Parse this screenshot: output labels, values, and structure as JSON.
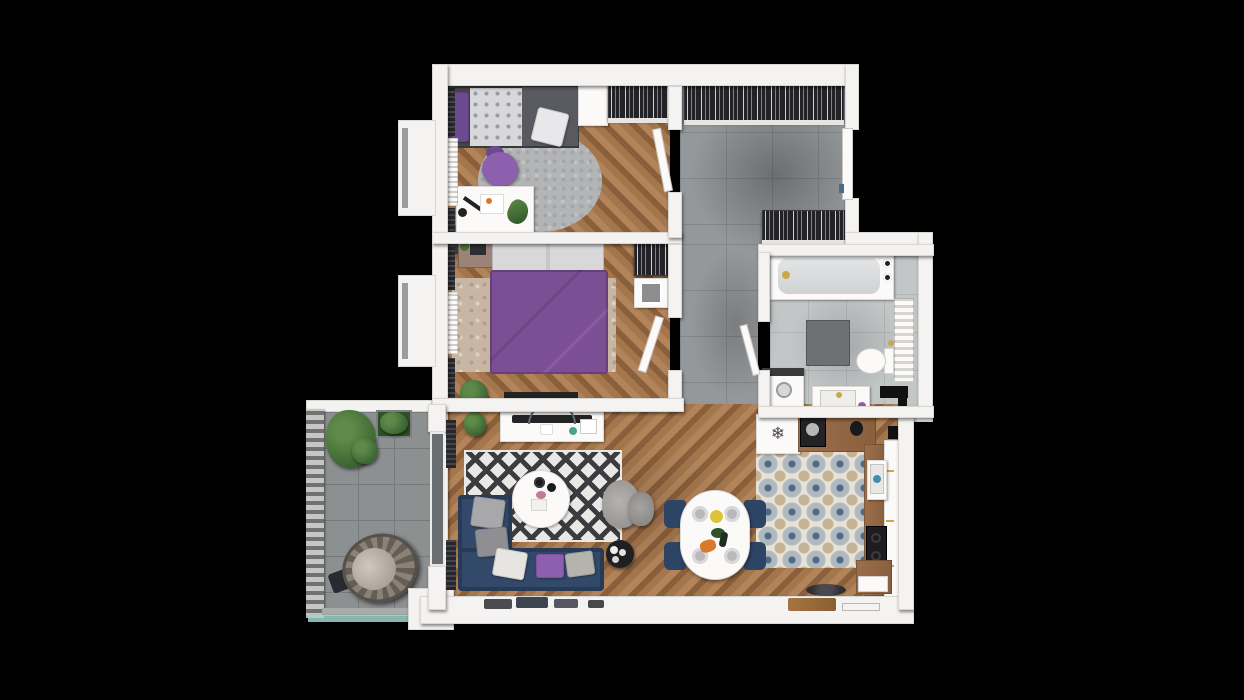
{
  "scene": {
    "description": "3D top-down floor plan render of a two-bedroom apartment with balcony on black background",
    "background_color": "#000000"
  },
  "icons": {
    "snowflake": "❄"
  },
  "colors": {
    "bg": "#000000",
    "wall": "#f4f3f1",
    "wallShade": "#d9d7d2",
    "wood1": "#a4764c",
    "wood2": "#8a5f3c",
    "wood3": "#b3845a",
    "hallTile": "#95989a",
    "hallLine": "#84878a",
    "bathTile": "#c3c6c7",
    "bathLine": "#b2b5b6",
    "balconyTile": "#8d9091",
    "balconyLine": "#767a7b",
    "kitTileBase": "#e6e2d8",
    "kitTileBlue": "#4a6c8a",
    "kitTileTan": "#c4b294",
    "sofaNavy": "#32496a",
    "sofaNavyDark": "#273a56",
    "chairNavy": "#2e4464",
    "bedPurple": "#7c4f94",
    "poufPurple": "#8e5fae",
    "pillowPurple": "#6b4a8f",
    "bedFrame": "#47474b",
    "blanketGray": "#595960",
    "duvetLight": "#d8d8da",
    "rugRound": "#b2b4b6",
    "rugBeige": "#c7b6a4",
    "rugDark": "#3c3c40",
    "rugLight": "#e9e8e6",
    "wardrobe": "#232327",
    "curtain": "#26262b",
    "plant": "#46713a",
    "plantDark": "#2f5228",
    "counterWood": "#9c6f4a",
    "appliance": "#232325",
    "steel": "#b7b7ba",
    "gold": "#c9a84c",
    "teal": "#9fd6cf",
    "glassGray": "#6a6d70",
    "white": "#fbfaf9",
    "accentGreen": "#4ba58c",
    "carrot": "#d97a2a",
    "lemon": "#ddc23c",
    "plate": "#b9b9bb"
  },
  "rooms": [
    {
      "name": "bedroom-1",
      "floor": "herringbone-wood",
      "furniture": [
        "single-bed",
        "purple-pillow",
        "floral-duvet",
        "gray-blanket",
        "dotted-pillow",
        "round-gray-rug",
        "purple-pouf",
        "white-desk",
        "desk-lamp",
        "desk-papers",
        "wardrobe-cabinet",
        "open-wardrobe-rack",
        "radiator",
        "dark-curtains",
        "window-bay"
      ]
    },
    {
      "name": "master-bedroom",
      "floor": "herringbone-wood",
      "furniture": [
        "double-bed-purple-duvet",
        "white-pillows",
        "beige-rug",
        "writing-desk",
        "desk-chair",
        "laptop",
        "nightstand",
        "shoe-rack",
        "potted-plant",
        "wall-tv",
        "radiator",
        "dark-curtains",
        "window-bay"
      ]
    },
    {
      "name": "entrance-hall",
      "floor": "gray-tile",
      "furniture": [
        "wardrobe-row-top",
        "entry-wardrobe",
        "entrance-door"
      ]
    },
    {
      "name": "bathroom",
      "floor": "gray-tile",
      "furniture": [
        "bathtub",
        "gold-faucet",
        "shower-mat",
        "toilet",
        "towel-radiator",
        "washing-machine",
        "vanity-sink",
        "ventilation-shaft"
      ]
    },
    {
      "name": "kitchen",
      "floor": "patterned-tile",
      "furniture": [
        "fridge",
        "coffee-machine",
        "wood-counter",
        "kettle",
        "kitchen-sink",
        "cooktop",
        "tall-cabinets",
        "corner-cabinet",
        "window-sill-plate"
      ]
    },
    {
      "name": "living-dining",
      "floor": "herringbone-wood",
      "furniture": [
        "navy-corner-sofa",
        "throw-pillows",
        "black-white-diamond-rug",
        "round-coffee-table",
        "gray-armchair",
        "ottoman",
        "black-side-table",
        "tv-console",
        "soundbar",
        "oval-dining-table",
        "navy-dining-chairs",
        "table-place-settings",
        "window-sill-items",
        "balcony-glass-door",
        "dark-curtains"
      ]
    },
    {
      "name": "balcony",
      "floor": "concrete-tile",
      "furniture": [
        "hanging-egg-chair",
        "large-potted-plant",
        "planter-box",
        "slatted-railing",
        "glass-balustrade"
      ]
    }
  ]
}
